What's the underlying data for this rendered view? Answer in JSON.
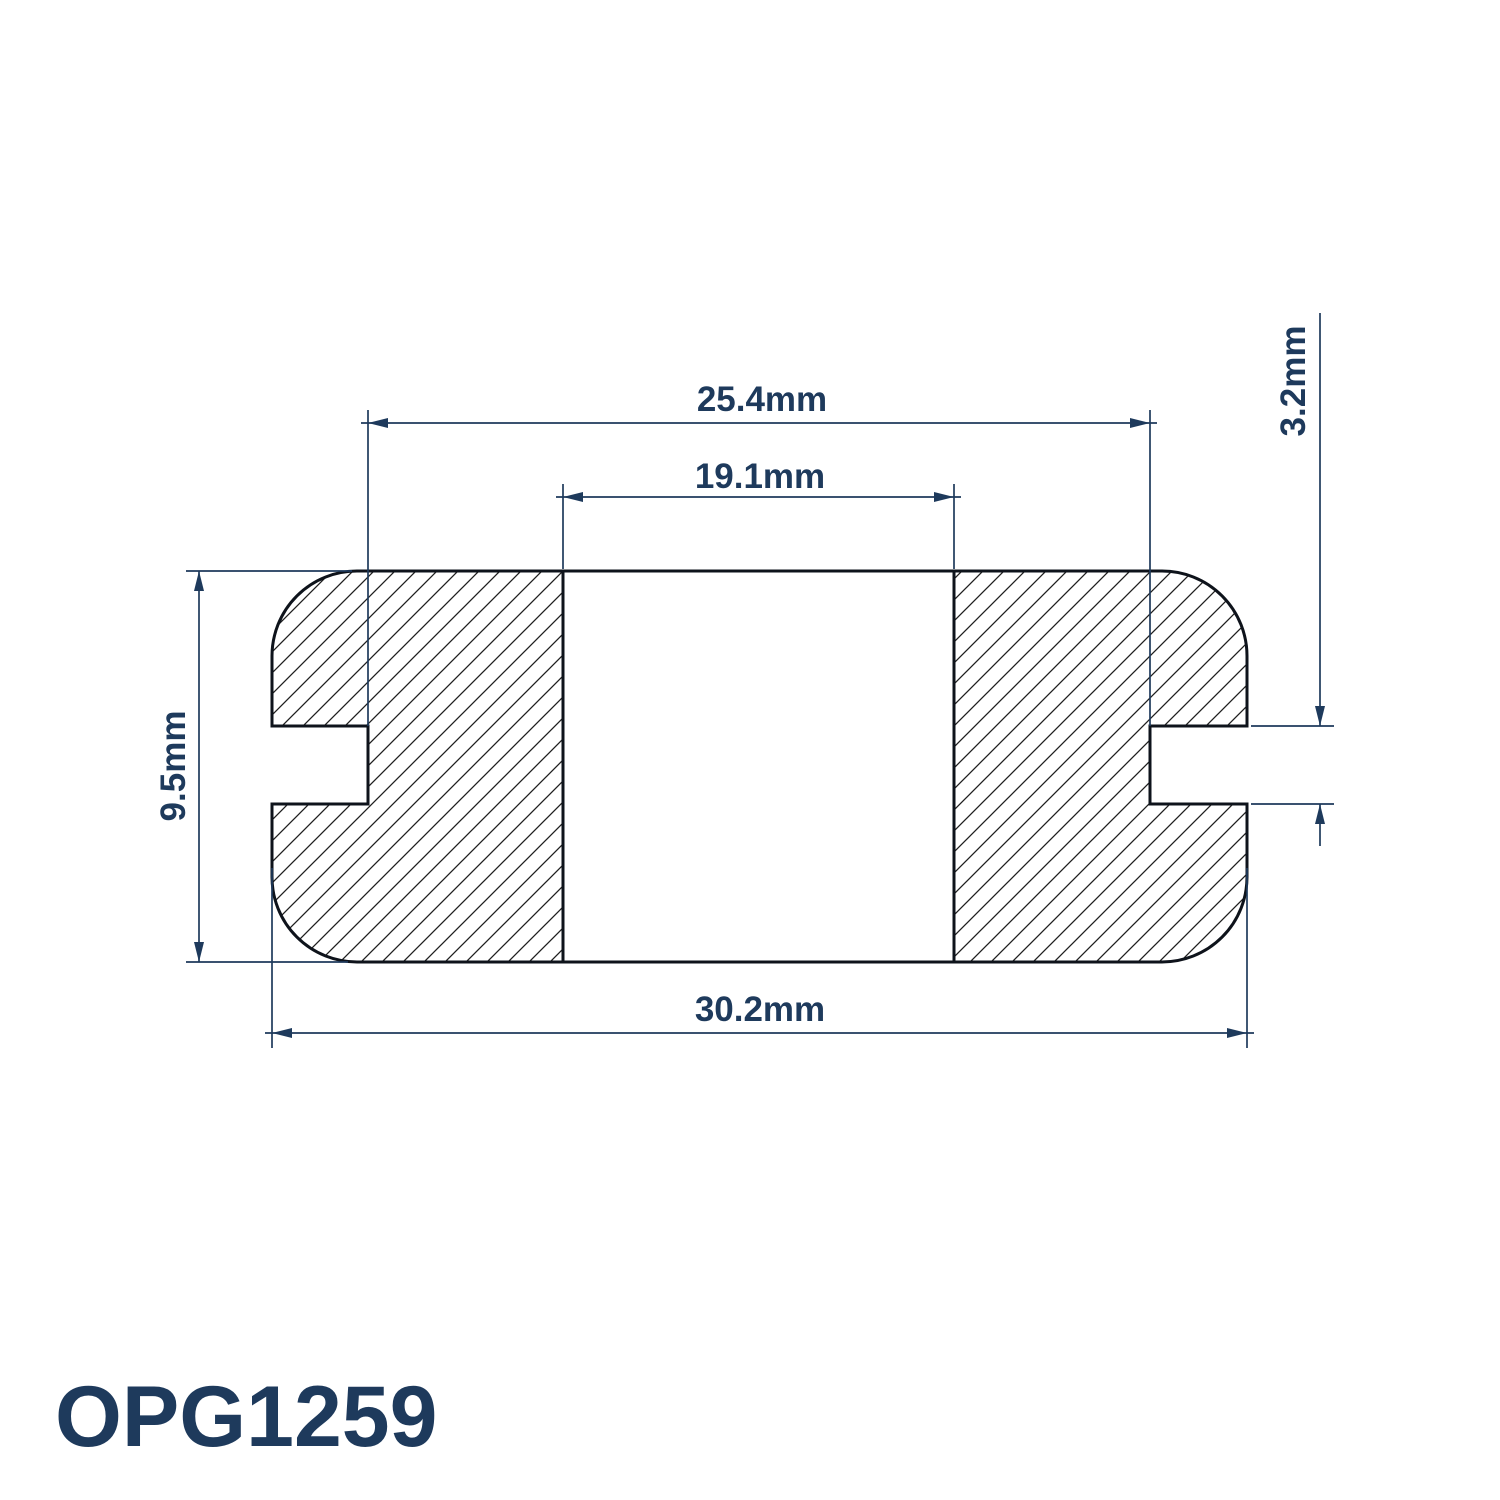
{
  "part_number": "OPG1259",
  "dimensions": {
    "groove_diameter": "25.4mm",
    "inner_diameter": "19.1mm",
    "overall_diameter": "30.2mm",
    "thickness": "9.5mm",
    "panel_groove_width": "3.2mm"
  },
  "colors": {
    "navy": "#1E3A5C",
    "outline": "#0E131B",
    "hatch": "#1F1F1F",
    "background": "#FFFFFF"
  }
}
